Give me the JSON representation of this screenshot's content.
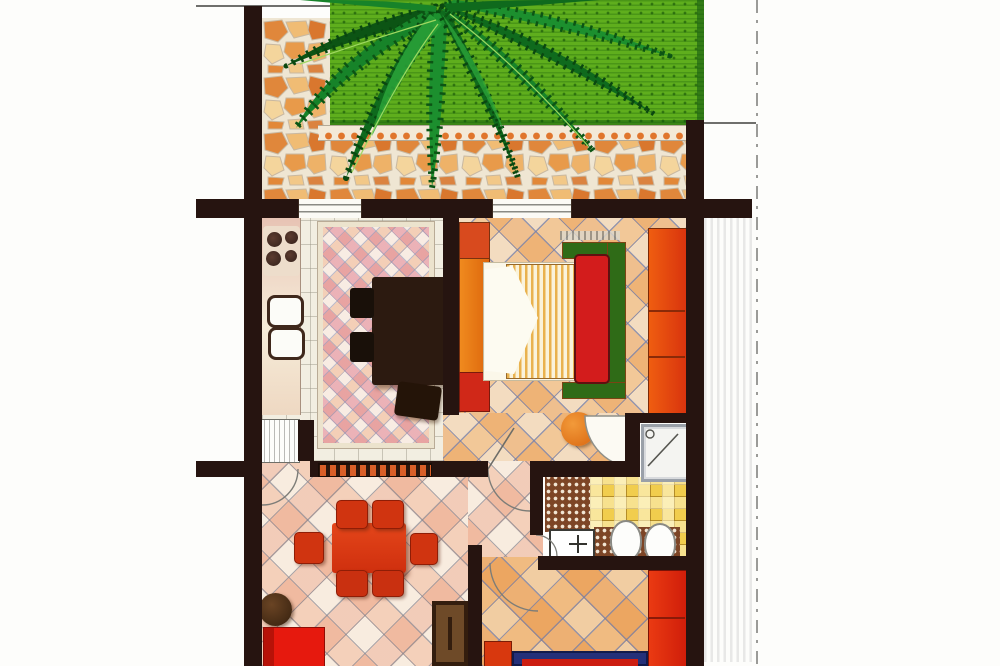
{
  "image_kind": "hand-drawn apartment floor plan illustration, top-down view, no text labels",
  "palette": {
    "wall": "#261410",
    "lawn_green": "#5fae1d",
    "palm_dark": "#0c5414",
    "palm_mid": "#178329",
    "palm_light": "#2aa33a",
    "paving_orange": "#e0873b",
    "paving_tan": "#eeb268",
    "paving_cream": "#f4d59c",
    "dot_border_orange": "#e0752c",
    "kitchen_rug_pink": "#de788c",
    "dining_table_brown": "#2c1a10",
    "bed_frame_green": "#2f6b17",
    "headboard_red": "#d31c1c",
    "blanket_stripe": "#e9b24e",
    "wardrobe_orange": "#ec7d12",
    "wardrobe_red": "#d02818",
    "tile_grout_blue": "#747ea8",
    "bath_floor_yellow": "#f1cd4d",
    "dotted_rug_brown": "#7d4526",
    "living_table_red": "#dd3b12",
    "sofa_red": "#e6190e",
    "coffee_table_brown": "#4a2c14",
    "tv_unit_brown": "#331d0e",
    "bed2_frame_blue": "#243079",
    "cabinet_red": "#dd2712",
    "shower_tray_gray": "#9aa0a8",
    "pouf_orange": "#e07518"
  },
  "outdoor": {
    "areas": [
      "lawn",
      "palm-tree",
      "stone-paved-patio",
      "orange-dot-tile-border"
    ],
    "boundary": [
      "thin-site-line-top-left",
      "dash-dot-property-line-right"
    ]
  },
  "rooms": [
    {
      "name": "patio-garden",
      "floor": "terracotta crazy paving"
    },
    {
      "name": "kitchen-dining",
      "floor": "white grid tiles with pink checkered rug",
      "furniture": [
        "stove-4-burners",
        "double-sink",
        "counter",
        "appliance-box",
        "dark-dining-table",
        "chairs",
        "wall-radiator"
      ]
    },
    {
      "name": "bedroom",
      "floor": "orange diagonal tiles",
      "furniture": [
        "double-bed-green-frame-red-headboard-striped-blanket",
        "pillow",
        "left-wardrobe",
        "right-wardrobe",
        "orange-pouf",
        "door-swing"
      ]
    },
    {
      "name": "shower-room",
      "furniture": [
        "shower-tray"
      ]
    },
    {
      "name": "bathroom",
      "floor": "yellow checkered tiles",
      "furniture": [
        "washbasin",
        "toilet",
        "bidet",
        "dotted-rug",
        "dotted-mat"
      ]
    },
    {
      "name": "living-room",
      "floor": "salmon diagonal tiles",
      "furniture": [
        "red-dining-table",
        "six-red-chairs",
        "round-coffee-table",
        "red-sofa",
        "tv-unit"
      ]
    },
    {
      "name": "second-bedroom",
      "floor": "orange diagonal tiles",
      "furniture": [
        "blue-frame-bed-red-cover",
        "red-nightstand",
        "red-cabinet"
      ]
    }
  ]
}
